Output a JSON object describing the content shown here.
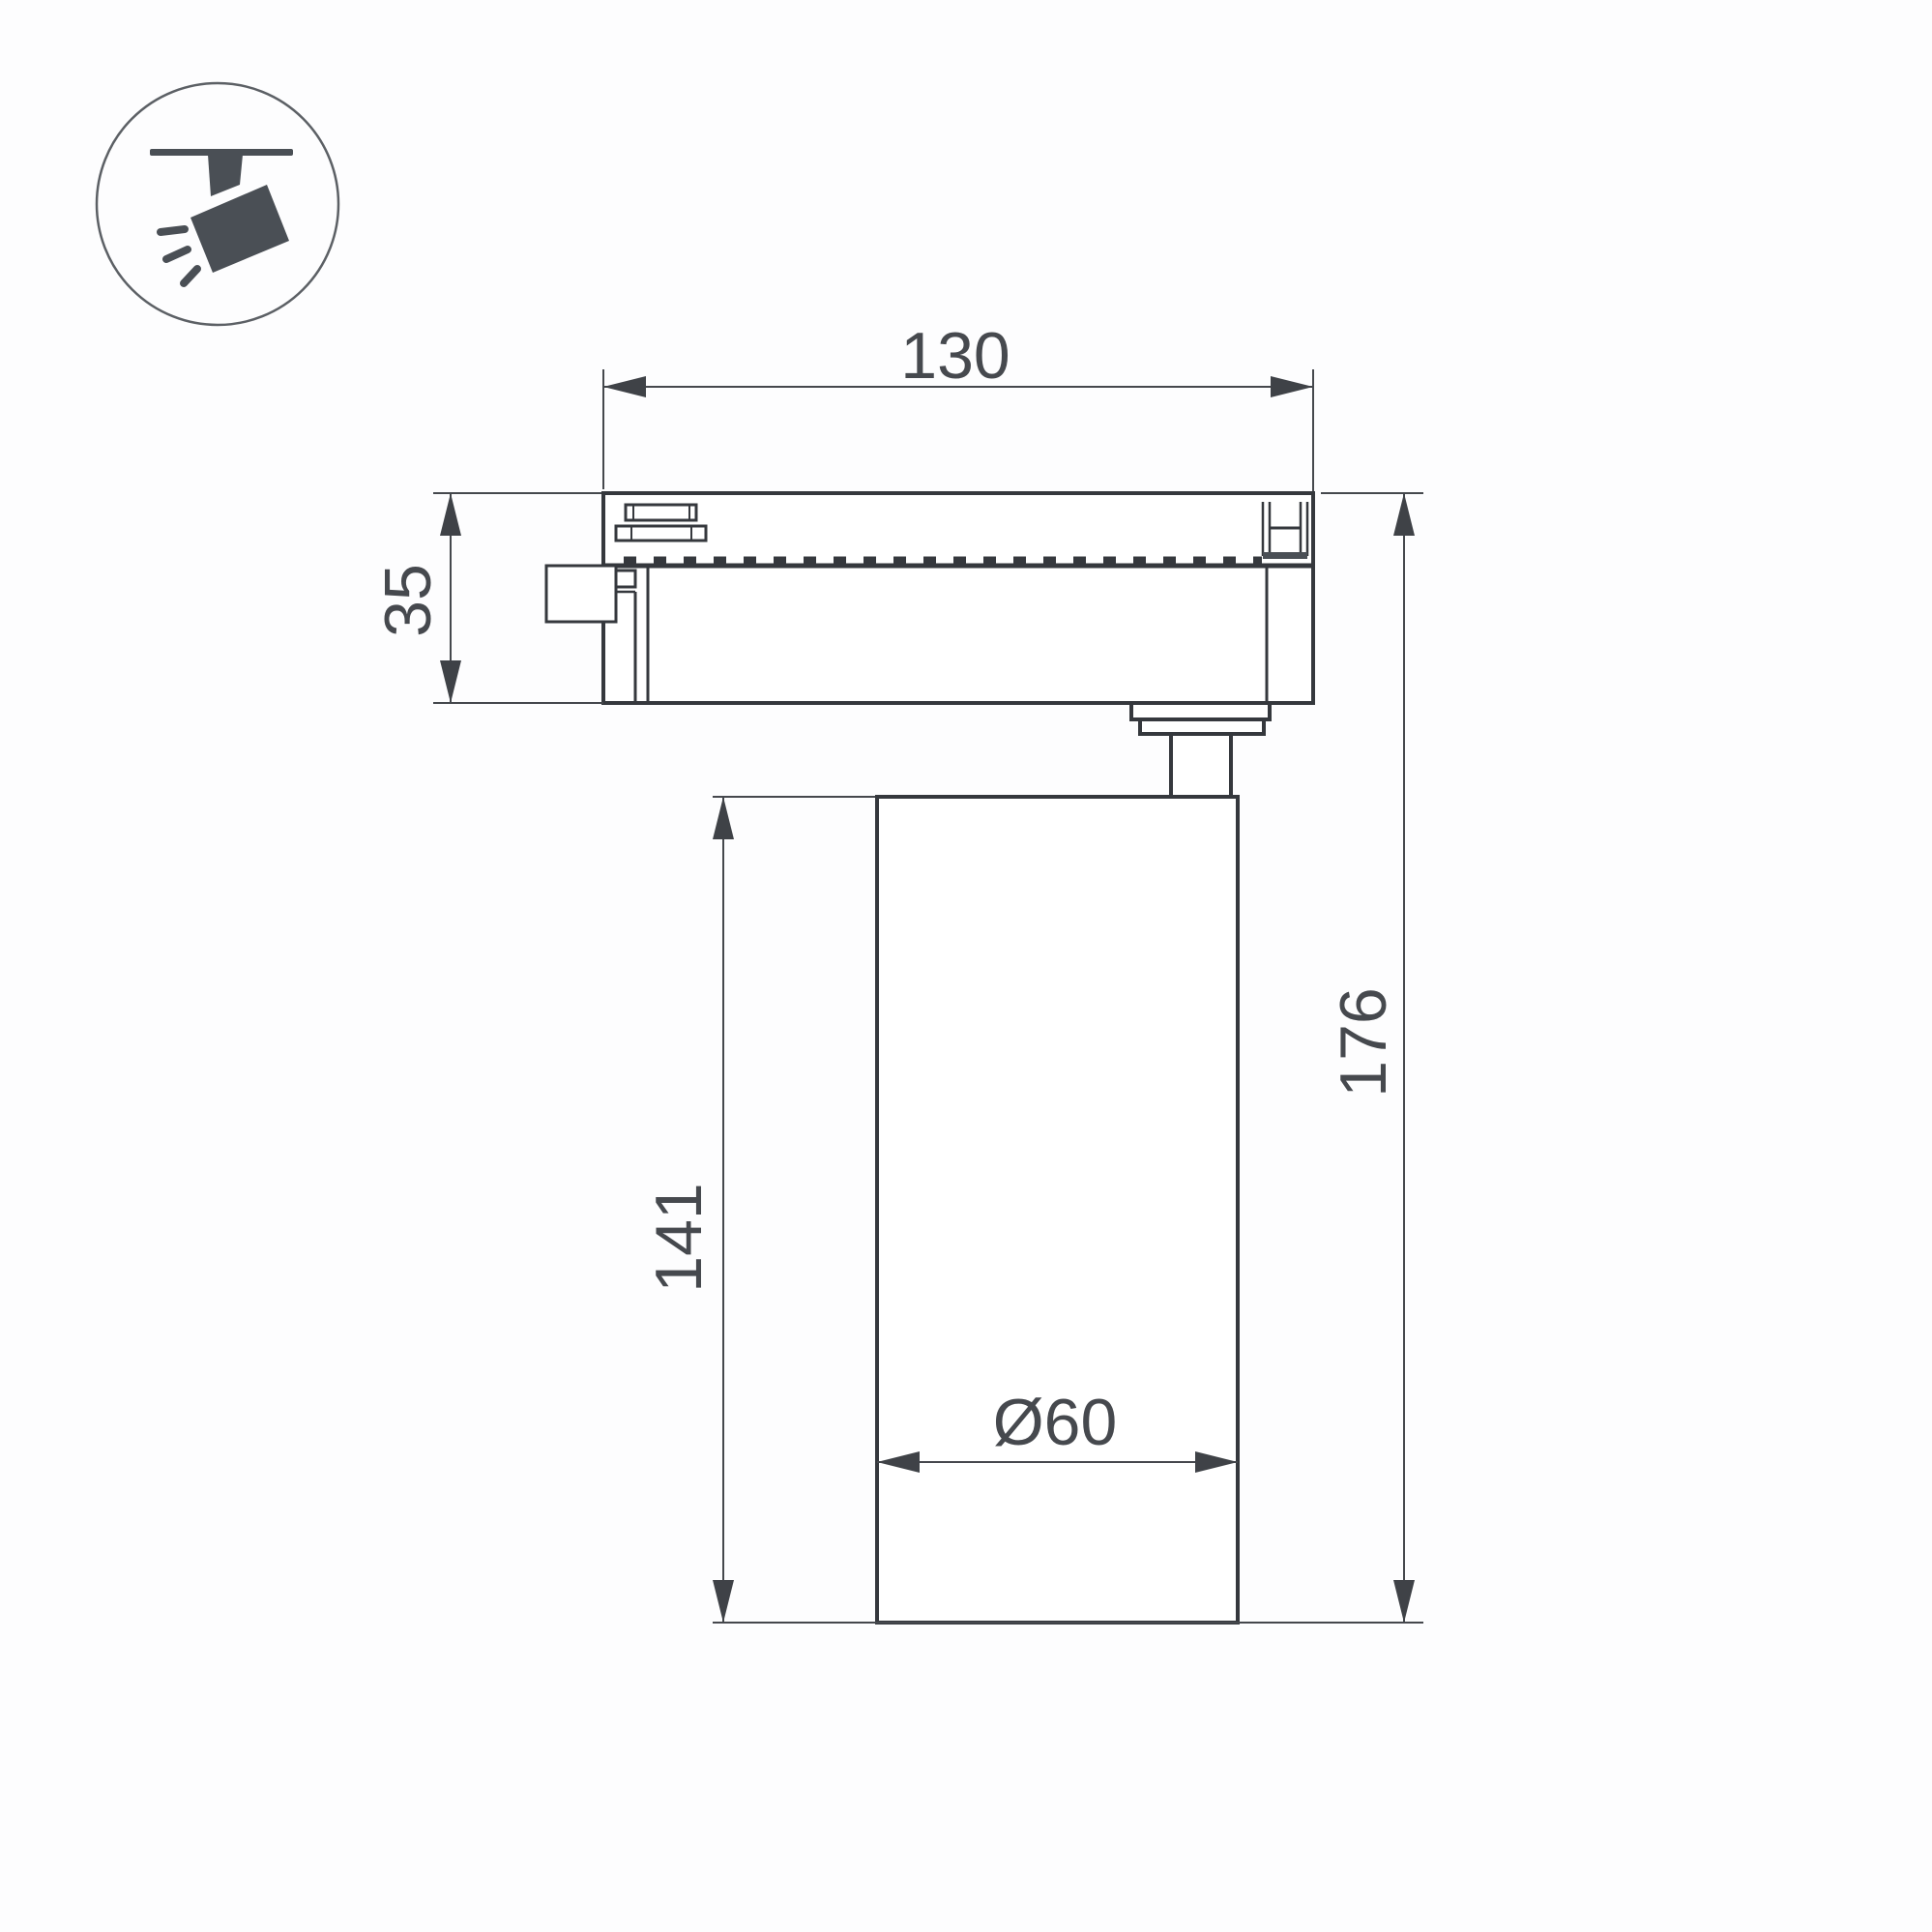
{
  "drawing_title": "track spotlight dimension drawing",
  "dims": {
    "track_width": {
      "label": "130",
      "orientation": "horizontal"
    },
    "adapter_height": {
      "label": "35",
      "orientation": "vertical"
    },
    "body_height": {
      "label": "141",
      "orientation": "vertical"
    },
    "total_height": {
      "label": "176",
      "orientation": "vertical"
    },
    "body_diameter": {
      "label": "Ø60",
      "orientation": "horizontal"
    }
  },
  "icon": {
    "meaning": "ceiling-track mounted spotlight"
  },
  "colors": {
    "background": "#fdfdfe",
    "outline": "#35383d",
    "dimension_lines": "#45484d",
    "text": "#46494e",
    "icon": "#4a4f55"
  }
}
